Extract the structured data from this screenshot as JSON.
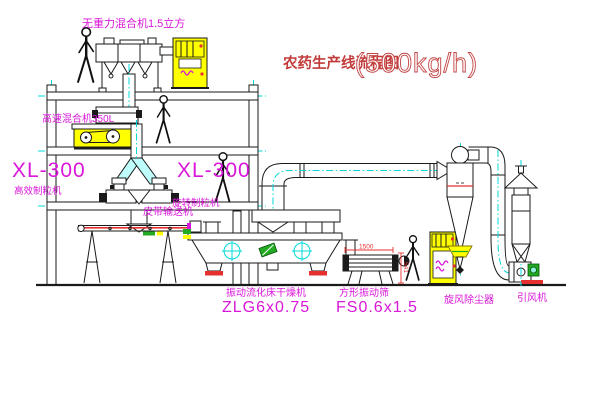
{
  "title": {
    "name_cn": "农药生产线流程图",
    "capacity": "(500kg/h)"
  },
  "labels": {
    "gravity_mixer": "无重力混合机1.5立方",
    "high_speed_mixer": "高速混合机350L",
    "granulator_left_model": "XL-300",
    "granulator_left_name": "高效制粒机",
    "granulator_mid_model": "XL-300",
    "granulator_mid_name": "旋转制粒机",
    "belt_conveyor": "皮带输送机",
    "dryer_name": "振动流化床干燥机",
    "dryer_model": "ZLG6x0.75",
    "sieve_name": "方形振动筛",
    "sieve_model": "FS0.6x1.5",
    "cyclone_name": "旋风除尘器",
    "fan_name": "引风机"
  },
  "dimensions": {
    "sieve_length": "1500",
    "sieve_height": "541"
  },
  "colors": {
    "line": "#1a1a1a",
    "label_magenta": "#d916d9",
    "title_red": "#c23b3b",
    "centerline_cyan": "#00d8d8",
    "cabinet_yellow": "#ffff00",
    "accent_red": "#e63030",
    "accent_green": "#22aa22"
  }
}
